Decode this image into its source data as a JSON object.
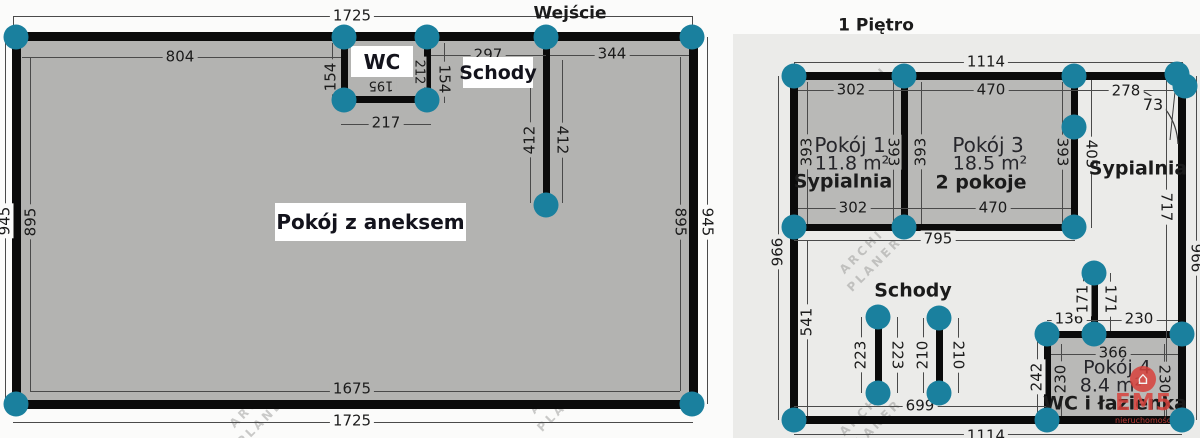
{
  "watermark": {
    "line1": "ARCHI",
    "line2": "PLANER"
  },
  "brand": {
    "icon": "⌂",
    "name": "EM5",
    "subtitle": "nieruchomości"
  },
  "colors": {
    "node": "#1a809e",
    "wall": "#0b0b0b",
    "brand_red": "#d8423c",
    "left_fill": "#b3b3b1",
    "right_panel": "#ebebe9",
    "room_fill": "#b9b9b7"
  },
  "plan_left": {
    "labels": {
      "entrance": "Wejście",
      "wc": "WC",
      "stairs": "Schody",
      "main_room": "Pokój z aneksem"
    },
    "dims": {
      "top_outer": "1725",
      "bottom_outer": "1725",
      "bottom_inner": "1675",
      "left_outer": "945",
      "right_outer": "945",
      "left_inner": "895",
      "right_inner": "895",
      "top_inner_left": "804",
      "top_inner_mid": "297",
      "top_inner_right": "344",
      "wc_left": "154",
      "wc_right": "154",
      "wc_bottom": "217",
      "wc_inner_w": "195",
      "wc_inner_h": "212",
      "stairs_wall_left": "412",
      "stairs_wall_right": "412"
    }
  },
  "plan_right": {
    "title": "1 Piętro",
    "rooms": {
      "room1_name": "Pokój 1",
      "room1_area": "11.8 m²",
      "room1_tag": "Sypialnia",
      "room3_name": "Pokój 3",
      "room3_area": "18.5 m²",
      "room3_tag": "2 pokoje",
      "room4_name": "Pokój 4",
      "room4_area": "8.4 m²",
      "room4_tag": "WC i łazienka",
      "bedroom": "Sypialnia",
      "stairs": "Schody"
    },
    "dims": {
      "top_outer": "1114",
      "bottom_outer": "1114",
      "left_outer": "966",
      "right_outer": "966",
      "left_inner": "541",
      "right_inner": "717",
      "room1_top": "302",
      "room1_bottom": "302",
      "room1_left": "393",
      "room1_right": "393",
      "room3_top": "470",
      "room3_bottom": "470",
      "room3_left": "393",
      "room3_right": "393",
      "hall_top": "278",
      "door": "73",
      "hall_vert": "405",
      "rooms_bottom": "795",
      "stair1_left": "223",
      "stair1_right": "223",
      "stair2_left": "210",
      "stair2_right": "210",
      "stairs_bottom": "699",
      "gap_left": "136",
      "gap_right": "230",
      "stub_left": "171",
      "stub_right": "171",
      "room4_top": "366",
      "room4_left_outer": "242",
      "room4_left": "230",
      "room4_right": "230"
    }
  }
}
